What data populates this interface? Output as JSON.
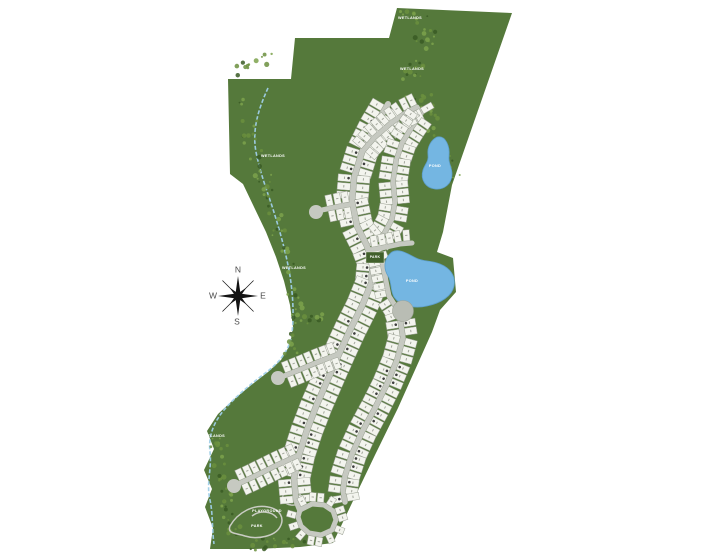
{
  "map": {
    "width": 720,
    "height": 556,
    "colors": {
      "background": "#ffffff",
      "land": "#55793b",
      "tree_dark": "#3a5a24",
      "tree_mid": "#6b8f3e",
      "tree_light": "#7da24c",
      "road": "#c6c9c1",
      "lot_fill": "#f3f4ee",
      "lot_stroke": "#9ba194",
      "lot_number": "#a3a69c",
      "marker_dot": "#3d3d3d",
      "pond_fill": "#74b6e2",
      "pond_edge": "#5d9fcb",
      "creek": "#9fcfe8",
      "trail": "#c9ccc3",
      "amenity": "#b9bdb4",
      "park_fill": "#41602b",
      "park_stroke": "#e8ecdf",
      "compass_star": "#141414",
      "compass_text": "#4c4c4c",
      "label_text": "#ffffff"
    },
    "boundary_points": "397,8 512,13 452,185 443,232 437,252 453,258 456,292 440,310 432,332 415,370 398,408 375,455 352,503 333,543 300,547 255,549 210,549 213,528 205,507 212,489 204,470 214,449 207,431 218,414 232,401 250,386 268,372 281,360 290,345 293,327 290,305 284,281 276,257 266,232 254,207 243,184 230,174 228,79 291,79 295,38 389,38",
    "creek_path": "M268,88 C258,110 252,130 256,152 C260,172 266,188 272,206 C279,228 286,252 290,276 C293,295 294,315 292,333 C290,348 282,360 268,371 C252,383 236,396 224,410 C214,422 208,436 210,452 C212,468 206,484 210,500 C213,514 212,530 214,544",
    "trails": [
      "M230,526 C238,512 254,504 268,507 C280,509 285,518 280,527 C275,536 258,540 245,536 C236,533 227,534 230,526 Z",
      "M252,516 C260,510 272,511 277,518",
      "M284,494 C290,489 298,490 301,496 C303,501 298,506 291,505 C285,504 280,499 284,494 Z"
    ],
    "tree_bands": [
      {
        "pts": [
          [
            402,
            12
          ],
          [
            418,
            22
          ],
          [
            428,
            38
          ],
          [
            420,
            60
          ],
          [
            408,
            76
          ],
          [
            415,
            92
          ],
          [
            430,
            105
          ],
          [
            442,
            122
          ]
        ],
        "count": 46,
        "spread": 9
      },
      {
        "pts": [
          [
            432,
            130
          ],
          [
            446,
            150
          ],
          [
            452,
            168
          ],
          [
            455,
            180
          ]
        ],
        "count": 14,
        "spread": 6
      },
      {
        "pts": [
          [
            243,
            95
          ],
          [
            248,
            118
          ],
          [
            252,
            140
          ],
          [
            258,
            162
          ],
          [
            266,
            186
          ],
          [
            274,
            210
          ],
          [
            282,
            234
          ],
          [
            288,
            258
          ],
          [
            292,
            282
          ],
          [
            295,
            306
          ],
          [
            296,
            330
          ],
          [
            290,
            352
          ]
        ],
        "count": 60,
        "spread": 8
      },
      {
        "pts": [
          [
            300,
            315
          ],
          [
            312,
            320
          ],
          [
            324,
            317
          ]
        ],
        "count": 12,
        "spread": 6
      },
      {
        "pts": [
          [
            214,
            440
          ],
          [
            226,
            456
          ],
          [
            220,
            474
          ],
          [
            228,
            492
          ],
          [
            222,
            510
          ],
          [
            232,
            526
          ],
          [
            246,
            538
          ],
          [
            262,
            544
          ],
          [
            282,
            544
          ],
          [
            302,
            540
          ]
        ],
        "count": 55,
        "spread": 7
      },
      {
        "pts": [
          [
            236,
            72
          ],
          [
            252,
            64
          ],
          [
            268,
            58
          ]
        ],
        "count": 12,
        "spread": 6
      }
    ],
    "roads": [
      {
        "id": "main-spine",
        "w": 6,
        "sides": [
          1,
          -1
        ],
        "pitch": 8.5,
        "depth": 13,
        "dots": true,
        "specks": true,
        "pts": [
          [
            388,
            104
          ],
          [
            374,
            128
          ],
          [
            362,
            152
          ],
          [
            354,
            178
          ],
          [
            352,
            202
          ],
          [
            357,
            226
          ],
          [
            366,
            244
          ],
          [
            373,
            262
          ],
          [
            371,
            284
          ],
          [
            362,
            306
          ],
          [
            350,
            330
          ],
          [
            339,
            354
          ],
          [
            328,
            379
          ],
          [
            317,
            404
          ],
          [
            307,
            430
          ],
          [
            299,
            455
          ],
          [
            294,
            478
          ],
          [
            296,
            500
          ],
          [
            300,
            510
          ]
        ]
      },
      {
        "id": "north-loop",
        "w": 5,
        "sides": [
          1,
          -1
        ],
        "pitch": 8,
        "depth": 12,
        "dots": false,
        "specks": true,
        "pts": [
          [
            362,
            152
          ],
          [
            375,
            137
          ],
          [
            391,
            123
          ],
          [
            407,
            112
          ],
          [
            417,
            107
          ],
          [
            421,
            114
          ],
          [
            412,
            127
          ],
          [
            402,
            143
          ],
          [
            396,
            161
          ],
          [
            393,
            181
          ],
          [
            395,
            201
          ],
          [
            392,
            219
          ],
          [
            384,
            234
          ],
          [
            372,
            244
          ]
        ]
      },
      {
        "id": "west-court",
        "w": 5,
        "sides": [
          1,
          -1
        ],
        "pitch": 8,
        "depth": 11,
        "dots": false,
        "specks": true,
        "bulb": [
          316,
          212,
          7
        ],
        "pts": [
          [
            352,
            204
          ],
          [
            336,
            207
          ],
          [
            322,
            210
          ]
        ]
      },
      {
        "id": "pond-lane",
        "w": 5,
        "sides": [
          -1
        ],
        "pitch": 8,
        "depth": 11,
        "dots": false,
        "specks": true,
        "pts": [
          [
            370,
            250
          ],
          [
            386,
            247
          ],
          [
            400,
            244
          ],
          [
            412,
            243
          ]
        ]
      },
      {
        "id": "lake-drive",
        "w": 5,
        "sides": [
          1
        ],
        "pitch": 8,
        "depth": 11,
        "dots": false,
        "specks": true,
        "pts": [
          [
            381,
            256
          ],
          [
            385,
            276
          ],
          [
            389,
            296
          ],
          [
            396,
            307
          ],
          [
            400,
            318
          ]
        ]
      },
      {
        "id": "outer-east",
        "w": 5.5,
        "sides": [
          1,
          -1
        ],
        "pitch": 8.5,
        "depth": 12,
        "dots": true,
        "specks": true,
        "pts": [
          [
            400,
            318
          ],
          [
            403,
            338
          ],
          [
            397,
            360
          ],
          [
            387,
            384
          ],
          [
            375,
            408
          ],
          [
            362,
            432
          ],
          [
            352,
            454
          ],
          [
            345,
            476
          ],
          [
            343,
            490
          ],
          [
            345,
            502
          ]
        ]
      },
      {
        "id": "west-branch-north",
        "w": 5,
        "sides": [
          1,
          -1
        ],
        "pitch": 8,
        "depth": 11,
        "dots": false,
        "specks": true,
        "bulb": [
          278,
          378,
          7
        ],
        "pts": [
          [
            339,
            354
          ],
          [
            318,
            362
          ],
          [
            299,
            370
          ],
          [
            284,
            376
          ]
        ]
      },
      {
        "id": "west-branch-south",
        "w": 5,
        "sides": [
          1,
          -1
        ],
        "pitch": 8,
        "depth": 11,
        "dots": false,
        "specks": true,
        "bulb": [
          234,
          486,
          7
        ],
        "pts": [
          [
            299,
            455
          ],
          [
            275,
            466
          ],
          [
            253,
            477
          ],
          [
            240,
            483
          ]
        ]
      },
      {
        "id": "south-court",
        "w": 5,
        "sides": [
          -1
        ],
        "pitch": 8,
        "depth": 9,
        "dots": false,
        "specks": true,
        "pts": [
          [
            300,
            510
          ],
          [
            312,
            504
          ],
          [
            324,
            505
          ],
          [
            333,
            511
          ],
          [
            336,
            520
          ],
          [
            332,
            530
          ],
          [
            321,
            535
          ],
          [
            309,
            533
          ],
          [
            301,
            526
          ],
          [
            298,
            517
          ],
          [
            300,
            510
          ]
        ]
      }
    ],
    "ponds": [
      {
        "name": "north-pond",
        "label": "POND",
        "label_x": 435,
        "label_y": 167,
        "label_fs": 3.8,
        "path": "M437,137 C431,140 427,147 428,155 C429,161 425,164 423,170 C420,180 426,188 435,189 C444,190 452,184 452,174 C452,167 448,163 449,156 C450,147 446,135 437,137 Z"
      },
      {
        "name": "middle-pond",
        "label": "POND",
        "label_x": 412,
        "label_y": 282,
        "label_fs": 3.8,
        "path": "M392,252 C384,258 383,268 388,276 C392,282 390,290 394,297 C400,306 414,309 427,306 C441,303 452,296 454,286 C456,276 450,268 440,264 C430,260 424,262 416,258 C408,254 399,248 392,252 Z"
      }
    ],
    "amenity_circle": {
      "cx": 403,
      "cy": 311,
      "r": 10.5
    },
    "park_square": {
      "x": 366,
      "y": 252,
      "w": 18,
      "h": 11,
      "label": "PARK",
      "label_x": 375,
      "label_y": 258,
      "label_fs": 3.4
    },
    "labels": [
      {
        "text": "WETLANDS",
        "x": 410,
        "y": 19,
        "fs": 3.8
      },
      {
        "text": "WETLANDS",
        "x": 412,
        "y": 70,
        "fs": 3.8
      },
      {
        "text": "WETLANDS",
        "x": 273,
        "y": 157,
        "fs": 3.8
      },
      {
        "text": "WETLANDS",
        "x": 294,
        "y": 269,
        "fs": 3.8
      },
      {
        "text": "PARK",
        "x": 282,
        "y": 301,
        "fs": 3.8
      },
      {
        "text": "WETLANDS",
        "x": 213,
        "y": 437,
        "fs": 3.8
      },
      {
        "text": "PLAYGROUND",
        "x": 267,
        "y": 512,
        "fs": 3.8
      },
      {
        "text": "PARK",
        "x": 257,
        "y": 527,
        "fs": 3.8
      }
    ],
    "compass": {
      "cx": 238,
      "cy": 296,
      "long": 20,
      "short": 12,
      "font_size": 8.5,
      "letters": [
        {
          "t": "N",
          "dx": 0,
          "dy": -26
        },
        {
          "t": "E",
          "dx": 25,
          "dy": 0
        },
        {
          "t": "S",
          "dx": -1,
          "dy": 26
        },
        {
          "t": "W",
          "dx": -25,
          "dy": 0
        }
      ]
    }
  }
}
